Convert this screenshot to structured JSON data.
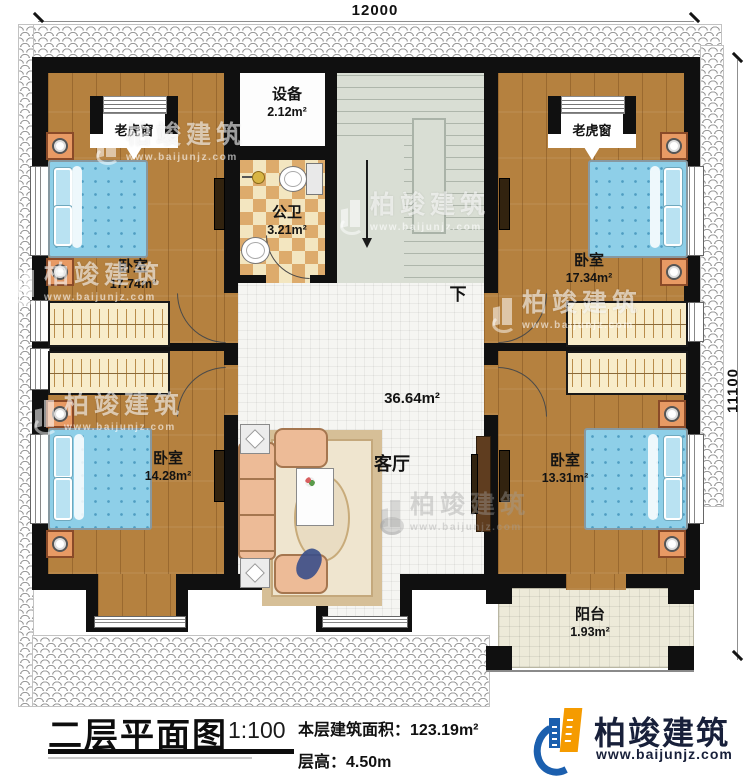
{
  "dimensions": {
    "width_mm": "12000",
    "height_mm": "11100"
  },
  "rooms": {
    "bedroom_tl": {
      "name": "卧室",
      "area": "17.74m²"
    },
    "bedroom_tr": {
      "name": "卧室",
      "area": "17.34m²"
    },
    "bedroom_bl": {
      "name": "卧室",
      "area": "14.28m²"
    },
    "bedroom_br": {
      "name": "卧室",
      "area": "13.31m²"
    },
    "equipment": {
      "name": "设备",
      "area": "2.12m²"
    },
    "bathroom": {
      "name": "公卫",
      "area": "3.21m²"
    },
    "living": {
      "name": "客厅",
      "area": "36.64m²"
    },
    "balcony": {
      "name": "阳台",
      "area": "1.93m²"
    }
  },
  "annotations": {
    "dormer": "老虎窗",
    "stairs_down": "下"
  },
  "title_block": {
    "title": "二层平面图",
    "scale": "1:100",
    "area_label": "本层建筑面积：",
    "area_value": "123.19m²",
    "height_label": "层高：",
    "height_value": "4.50m"
  },
  "brand": {
    "name": "柏竣建筑",
    "website": "www.baijunjz.com"
  },
  "watermark": {
    "name": "柏竣建筑",
    "website": "www.baijunjz.com"
  },
  "colors": {
    "wall": "#101010",
    "wood": "#b5813f",
    "checker": "#ddab6c",
    "stairs": "#d9ded4",
    "bed": "#8ecfe8",
    "brand_orange": "#f59b00",
    "brand_blue": "#1b5fae"
  }
}
